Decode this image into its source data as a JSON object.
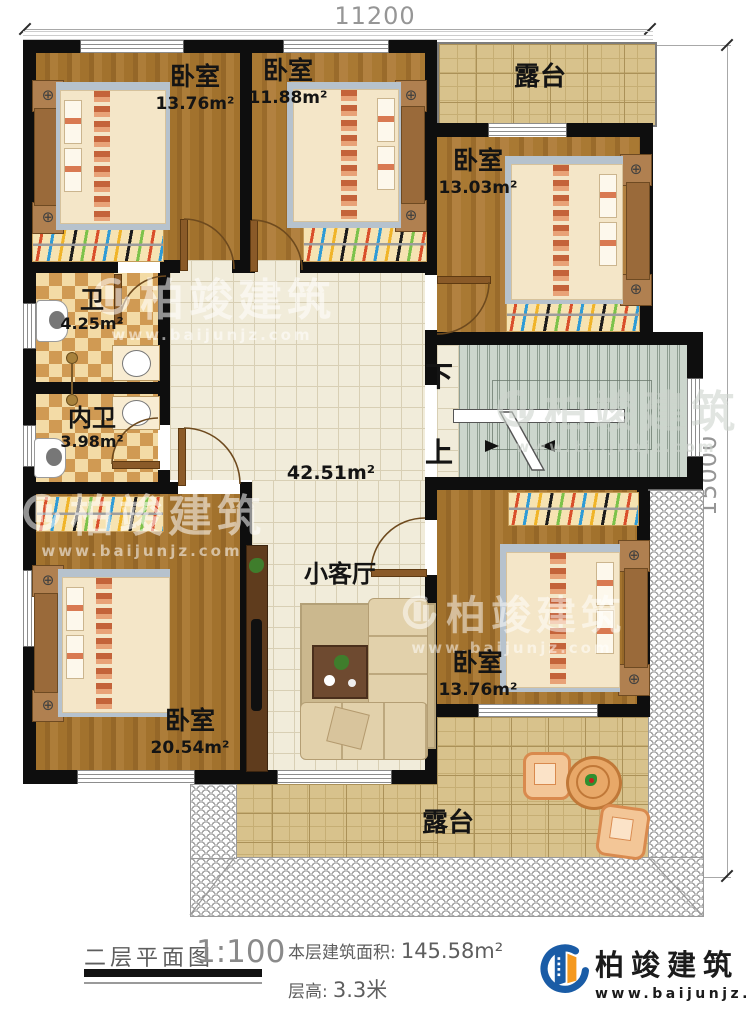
{
  "dimensions": {
    "top": "11200",
    "right": "15000"
  },
  "rooms": {
    "bedroom_tl": {
      "label": "卧室",
      "area": "13.76m²"
    },
    "bedroom_tm": {
      "label": "卧室",
      "area": "11.88m²"
    },
    "bedroom_r": {
      "label": "卧室",
      "area": "13.03m²"
    },
    "bath": {
      "label": "卫",
      "area": "4.25m²"
    },
    "ensuite": {
      "label": "内卫",
      "area": "3.98m²"
    },
    "hall": {
      "area": "42.51m²"
    },
    "living": {
      "label": "小客厅"
    },
    "bedroom_br": {
      "label": "卧室",
      "area": "13.76m²"
    },
    "bedroom_bl": {
      "label": "卧室",
      "area": "20.54m²"
    },
    "terrace_top": {
      "label": "露台"
    },
    "terrace_bottom": {
      "label": "露台"
    }
  },
  "stairs": {
    "down": "下",
    "up": "上"
  },
  "title_block": {
    "title": "二层平面图",
    "scale": "1:100",
    "area_label": "本层建筑面积:",
    "area_value": "145.58m²",
    "height_label": "层高:",
    "height_value": "3.3米"
  },
  "branding": {
    "company": "柏竣建筑",
    "website": "www.baijunjz.com"
  },
  "watermark": {
    "company": "柏竣建筑",
    "website": "www.baijunjz.com"
  },
  "colors": {
    "wall": "#0e0e0e",
    "wood_floor": "#a2722d",
    "hall_tile": "#f1ecda",
    "terrace_tile": "#d8c28c",
    "bath_checker": "#d09a53",
    "stair": "#ccd6cd",
    "logo_blue": "#1a5ca6",
    "logo_orange": "#f5991f"
  }
}
